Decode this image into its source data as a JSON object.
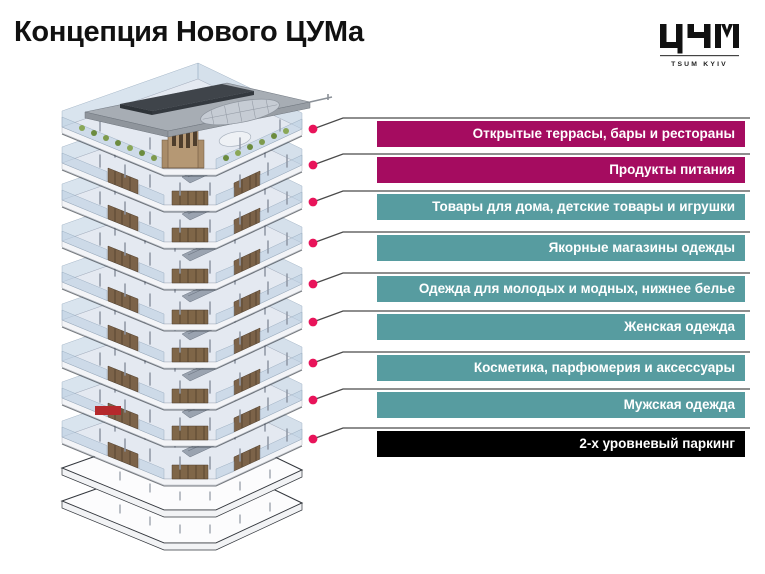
{
  "slide": {
    "title": "Концепция Нового ЦУМа",
    "background": "#ffffff"
  },
  "logo": {
    "wordmark": "ЦУМ",
    "caption": "TSUM KYIV"
  },
  "legend": {
    "colors": {
      "food_beverage": "#A50C60",
      "retail": "#579CA0",
      "parking": "#000000",
      "connector_dot": "#E8145A",
      "connector_line": "#4A4A4A"
    },
    "items": [
      {
        "label": "Открытые террасы, бары и рестораны",
        "color": "#A50C60"
      },
      {
        "label": "Продукты питания",
        "color": "#A50C60"
      },
      {
        "label": "Товары для дома, детские товары и игрушки",
        "color": "#579CA0"
      },
      {
        "label": "Якорные магазины одежды",
        "color": "#579CA0"
      },
      {
        "label": "Одежда для молодых и модных, нижнее белье",
        "color": "#579CA0"
      },
      {
        "label": "Женская одежда",
        "color": "#579CA0"
      },
      {
        "label": "Косметика, парфюмерия и аксессуары",
        "color": "#579CA0"
      },
      {
        "label": "Мужская одежда",
        "color": "#579CA0"
      },
      {
        "label": "2-х уровневый паркинг",
        "color": "#000000"
      }
    ]
  }
}
